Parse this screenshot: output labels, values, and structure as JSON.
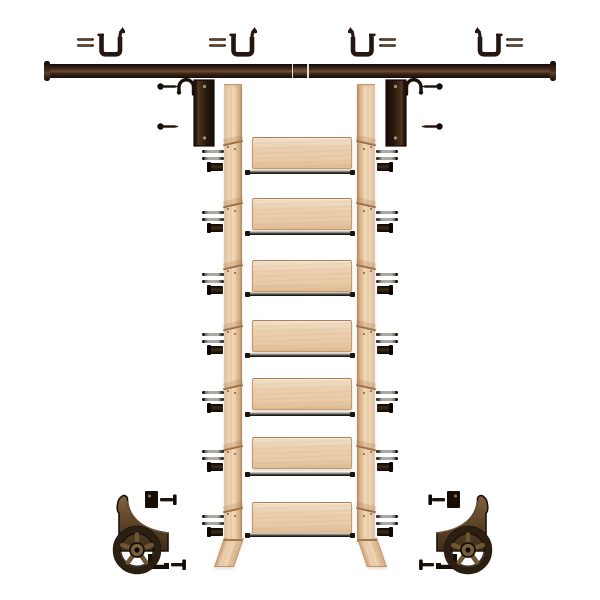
{
  "scene": {
    "background": "#ffffff",
    "kind": "product-illustration"
  },
  "palette": {
    "hardware_dark": "#241610",
    "bronze": "#6e5535",
    "steel": "#ababa6",
    "wood_light": "#f0d6b6",
    "wood_mid": "#ebcfae",
    "wood_edge": "#c29a6f",
    "rail_highlight": "#6e4d35"
  },
  "components": {
    "rail_mounting_brackets": 4,
    "wall_rail_sections": 2,
    "ladder_hook_brackets": 2,
    "side_rails": 2,
    "treads": 7,
    "tread_rods": 7,
    "tread_hardware_sets": 14,
    "roller_assemblies": 2
  },
  "wall_rail": {
    "x": 48,
    "y": 64,
    "width": 504,
    "height": 14
  },
  "top_brackets": {
    "y": 26,
    "items": [
      {
        "x": 76,
        "flip": false
      },
      {
        "x": 208,
        "flip": false
      },
      {
        "x": 348,
        "flip": true
      },
      {
        "x": 475,
        "flip": true
      }
    ]
  },
  "hook_brackets": {
    "y": 78,
    "items": [
      {
        "x": 156,
        "flip": false
      },
      {
        "x": 382,
        "flip": true
      }
    ]
  },
  "ladder": {
    "side_rails": {
      "left_x": 224,
      "right_x": 357,
      "width": 18,
      "top": 84,
      "height": 456,
      "joint_ys": [
        141,
        203,
        265,
        326,
        385,
        446,
        508
      ],
      "foot_height": 28
    },
    "treads": {
      "x": 252,
      "width": 98,
      "height": 30,
      "tops": [
        137,
        198,
        260,
        320,
        378,
        437,
        502
      ]
    },
    "rods": {
      "x": 246,
      "width": 108,
      "ys": [
        170,
        231,
        292,
        353,
        412,
        472,
        533
      ]
    },
    "hardware_sets": {
      "left_x": 202,
      "right_x": 376,
      "dy": 13
    }
  },
  "rollers": {
    "y": 487,
    "items": [
      {
        "x": 95,
        "flip": false
      },
      {
        "x": 418,
        "flip": true
      }
    ]
  }
}
